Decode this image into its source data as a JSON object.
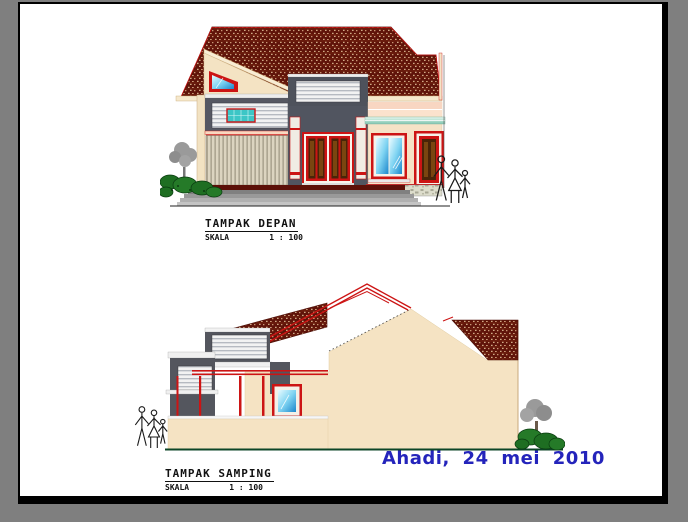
{
  "page": {
    "background": "#7f7f7f",
    "paper": "#ffffff",
    "frame": "#000000"
  },
  "palette": {
    "accent-red": "#cc1414",
    "roof-tile": "#5f1309",
    "wall-cream": "#f5e3c3",
    "wall-gray": "#53565e",
    "glass-blue": "#5ec8f0",
    "glass-teal": "#3cc6c6",
    "foliage-green": "#1e6e22",
    "ground-green": "#0c4527",
    "signature-blue": "#2424bb",
    "title-ink": "#111111"
  },
  "drawings": {
    "front_elevation": {
      "title": "TAMPAK DEPAN",
      "scale_label": "SKALA",
      "scale_value": "1 : 100"
    },
    "side_elevation": {
      "title": "TAMPAK SAMPING",
      "scale_label": "SKALA",
      "scale_value": "1 : 100"
    }
  },
  "signature": {
    "text": "Ahadi, 24 mei 2010"
  }
}
